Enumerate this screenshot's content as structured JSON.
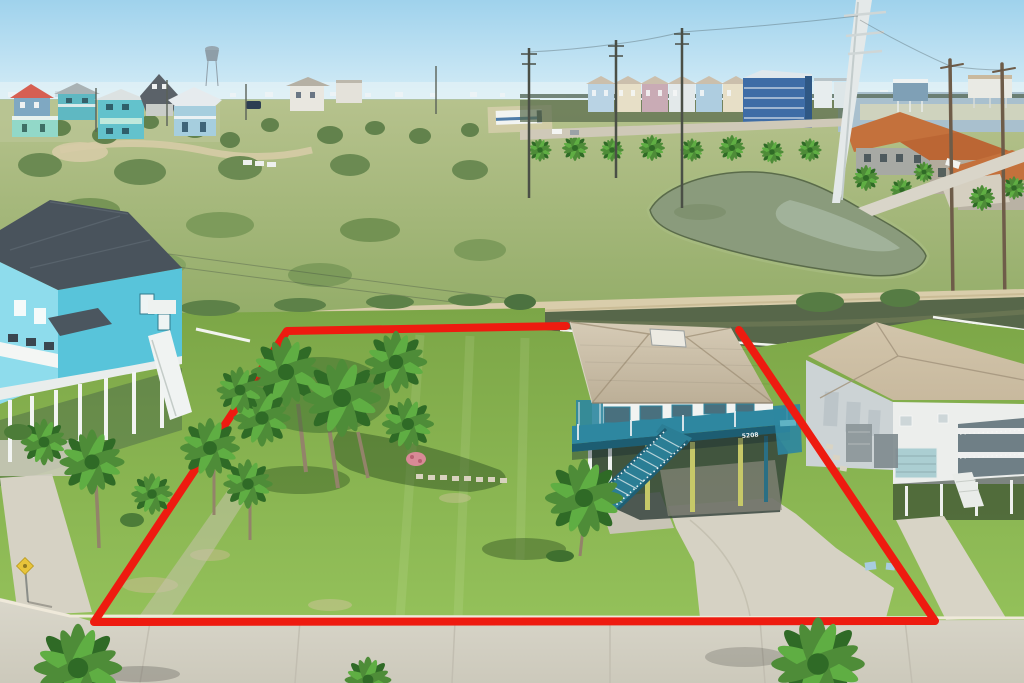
{
  "scene": {
    "description": "aerial-drone-photo-of-beachside-lot-outlined-in-red",
    "subject_house": {
      "house_number": "5208"
    },
    "annotation": {
      "type": "property-boundary-polygon",
      "style": "thick-solid-line"
    }
  },
  "colors": {
    "sky_top": "#9fd2ec",
    "sky_horizon": "#d6edf7",
    "haze": "#e8f3f7",
    "field_light": "#b6c28d",
    "field_mid": "#92ac67",
    "dirt_road": "#d9cdab",
    "pond_water": "#8a9b7c",
    "pond_water_light": "#b5c4b2",
    "canal_water": "#57674a",
    "lawn_top": "#7ca647",
    "lawn_bottom": "#94c15a",
    "street": "#dad7cb",
    "curb": "#efe9da",
    "concrete": "#d6d2c4",
    "red_outline": "#ee1b10",
    "subject_roof_light": "#d6cbb6",
    "subject_roof_dark": "#bcaf97",
    "subject_wall": "#f1f3f1",
    "deck_teal": "#2e87a0",
    "deck_teal_dark": "#1d5d72",
    "stair_teal": "#2b7e95",
    "stilt_yellow": "#c6c868",
    "skylight": "#eceae2",
    "left_house_wall": "#58c4da",
    "left_house_front": "#8edcec",
    "left_house_roof": "#49535c",
    "right_house_wall": "#eceeec",
    "right_house_wall_shaded": "#ccd3d5",
    "right_house_roof": "#c8b99e",
    "garage_door": "#abced2",
    "condo_blue": "#3e6ca6",
    "condo_roof": "#cbbfac",
    "terracotta": "#c4713c",
    "bay_water": "#a9c0ce",
    "palm_green": "#4e8c38",
    "palm_green_bright": "#5fae43",
    "palm_dark": "#2f6a26",
    "trunk": "#93836a",
    "shrub": "#5e7f49",
    "white_trim": "#f2f4ef",
    "sign_yellow": "#e8c43a",
    "pole_white": "#e4e9e9",
    "pole_wood": "#6e5c49",
    "rv_stripe": "#4f7ca8",
    "suv_dark": "#2d3e52",
    "pink_bush": "#d88a96"
  }
}
